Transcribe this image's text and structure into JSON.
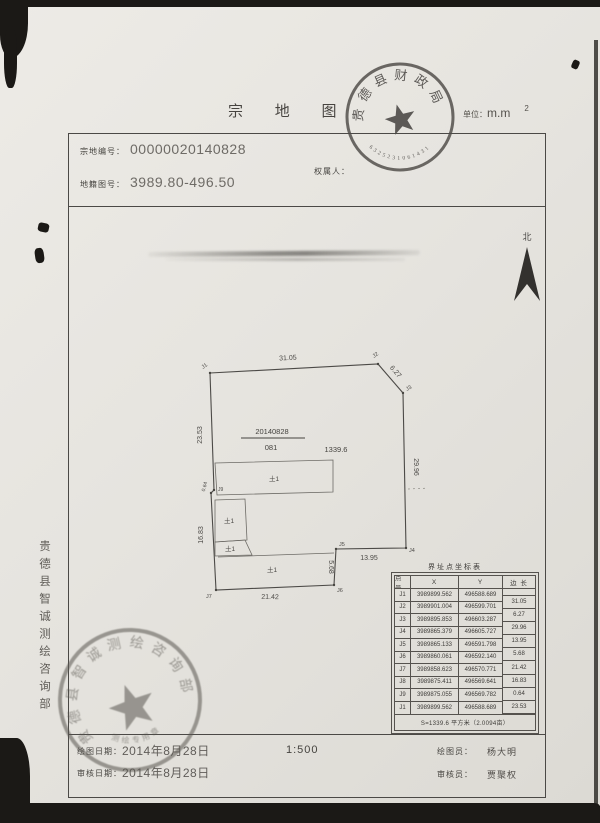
{
  "page": {
    "title": "宗 地 图",
    "unit_prefix": "单位：",
    "unit_value": "m.m",
    "unit_sup": "2"
  },
  "header": {
    "parcel_no_label": "宗地编号：",
    "parcel_no": "00000020140828",
    "sheet_no_label": "地籍图号：",
    "sheet_no": "3989.80-496.50",
    "owner_label": "权属人："
  },
  "north_label": "北",
  "seals": {
    "top": {
      "arc_text": "贵德县财政局",
      "number": "6325231061431"
    },
    "bottom": {
      "arc_text": "贵德县智诚测绘咨询部",
      "sub_text": "测绘专用章"
    }
  },
  "side_text": "贵德县智诚测绘咨询部",
  "drawing": {
    "parcel_no": "20140828",
    "sheet_code": "081",
    "area": "1339.6",
    "points": [
      "J1",
      "J2",
      "J3",
      "J4",
      "J5",
      "J6",
      "J7",
      "J8",
      "J9"
    ],
    "edges": {
      "e12": "31.05",
      "e23": "6.27",
      "e34": "29.96",
      "e45": "13.95",
      "e56": "5.68",
      "e67": "21.42",
      "e78": "16.83",
      "e89": "0.64",
      "e91": "23.53"
    },
    "buildings": [
      "土1",
      "土1",
      "土1",
      "土1"
    ]
  },
  "table": {
    "title": "界址点坐标表",
    "col_pt": "点 号",
    "col_x": "X",
    "col_y": "Y",
    "col_len": "边 长",
    "rows": [
      {
        "pt": "J1",
        "x": "3989899.562",
        "y": "496588.689"
      },
      {
        "pt": "J2",
        "x": "3989901.004",
        "y": "496599.701"
      },
      {
        "pt": "J3",
        "x": "3989895.853",
        "y": "496603.287"
      },
      {
        "pt": "J4",
        "x": "3989865.379",
        "y": "496605.727"
      },
      {
        "pt": "J5",
        "x": "3989865.133",
        "y": "496591.798"
      },
      {
        "pt": "J6",
        "x": "3989860.061",
        "y": "496592.140"
      },
      {
        "pt": "J7",
        "x": "3989858.623",
        "y": "496570.771"
      },
      {
        "pt": "J8",
        "x": "3989875.411",
        "y": "496569.641"
      },
      {
        "pt": "J9",
        "x": "3989875.055",
        "y": "496569.782"
      },
      {
        "pt": "J1",
        "x": "3989899.562",
        "y": "496588.689"
      }
    ],
    "lens": [
      "31.05",
      "6.27",
      "29.96",
      "13.95",
      "5.68",
      "21.42",
      "16.83",
      "0.64",
      "23.53"
    ],
    "summary": "S=1339.6 平方米（2.0094亩）"
  },
  "footer": {
    "draw_date_label": "绘图日期：",
    "draw_date": "2014年8月28日",
    "review_date_label": "审核日期：",
    "review_date": "2014年8月28日",
    "scale": "1:500",
    "drafter_label": "绘图员：",
    "drafter": "杨大明",
    "reviewer_label": "审核员：",
    "reviewer": "贾聚权"
  }
}
